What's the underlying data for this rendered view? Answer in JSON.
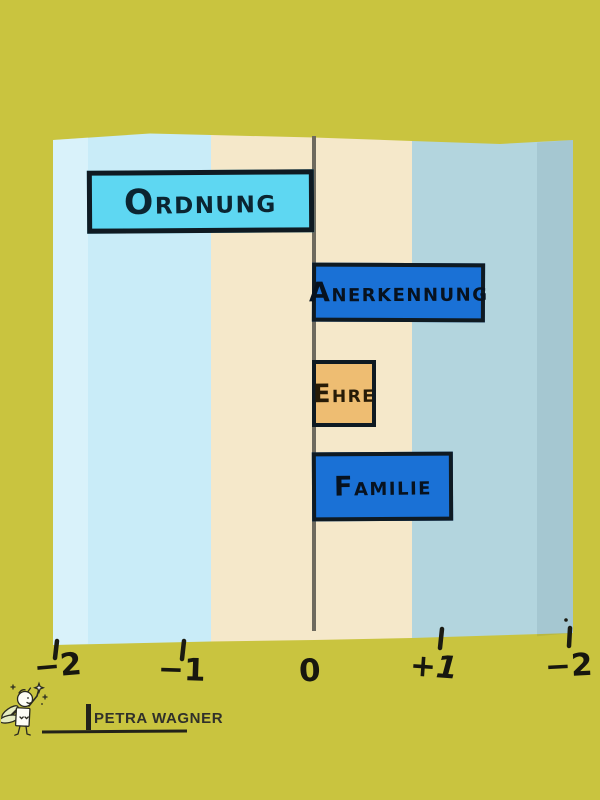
{
  "background_color": "#c9c43f",
  "chart_data": {
    "type": "bar",
    "orientation": "horizontal",
    "title": "",
    "xlabel": "",
    "ylabel": "",
    "categories": [
      "Ordnung",
      "Anerkennung",
      "Ehre",
      "Familie"
    ],
    "values": [
      -1.78,
      1.34,
      0.49,
      1.09
    ],
    "xlim": [
      -2,
      2
    ],
    "x_tick_labels": [
      "−2",
      "−1",
      "0",
      "+1",
      "−2"
    ],
    "bar_colors": [
      "#5ed7f2",
      "#1a71d6",
      "#eebd72",
      "#1a71d6"
    ],
    "band_colors": [
      "#c9ecf8",
      "#f5e8ca",
      "#b3d5de"
    ],
    "zero_line_color": "#6e6a5e",
    "grid": "off",
    "legend": "none"
  },
  "signature": {
    "name": "PETRA WAGNER"
  },
  "icons": {
    "fairy_doodle": "fairy-with-magic-wand-doodle"
  }
}
